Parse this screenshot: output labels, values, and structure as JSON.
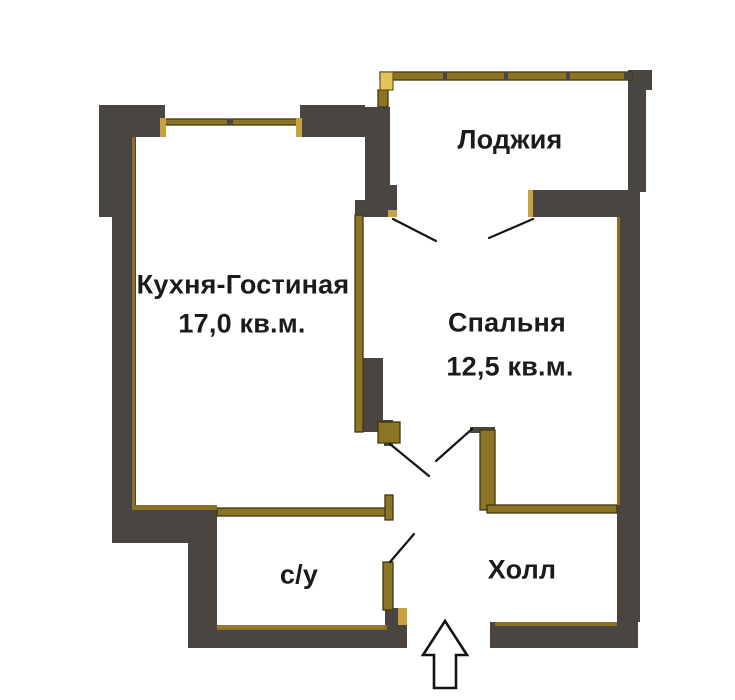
{
  "plan": {
    "colors": {
      "background": "#ffffff",
      "wall_dark": "#4a4540",
      "wall_trim": "#8c7425",
      "wall_trim_bright": "#c9a240",
      "window_yellow": "#e4c45a",
      "door_line": "#141414",
      "text": "#1b1b1b"
    },
    "rooms": [
      {
        "id": "loggia",
        "label": "Лоджия"
      },
      {
        "id": "kitchen_living",
        "label": "Кухня-Гостиная",
        "area": "17,0 кв.м."
      },
      {
        "id": "bedroom",
        "label": "Спальня",
        "area": "12,5 кв.м."
      },
      {
        "id": "bathroom",
        "label": "с/у"
      },
      {
        "id": "hall",
        "label": "Холл"
      }
    ],
    "icons": [
      {
        "name": "entrance-arrow-icon",
        "meaning": "entrance direction arrow"
      }
    ]
  }
}
